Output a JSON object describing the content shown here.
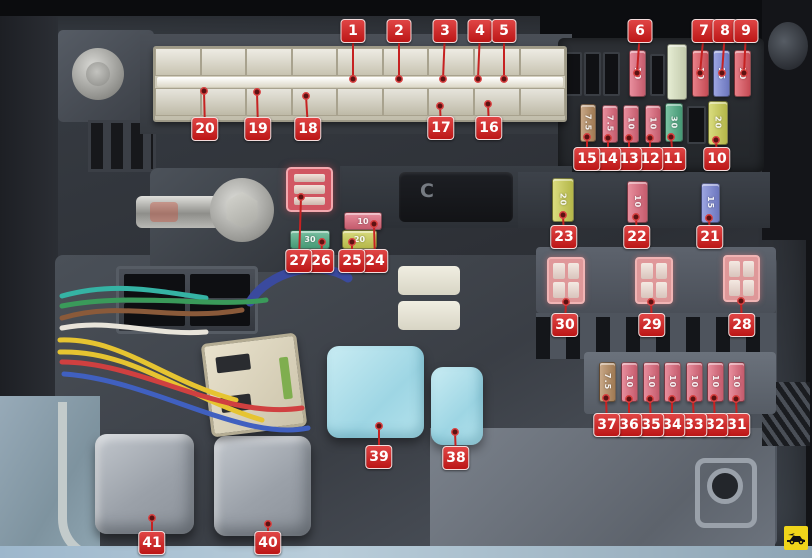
{
  "figure": {
    "type": "annotated-photo-diagram",
    "subject": "engine compartment fuse and relay box",
    "relay_cover_letter": "C",
    "watermark_icon": "car-logo",
    "accent_color": "#c81e1e",
    "callout_bg": "#c81e1e"
  },
  "amp_values_visible": [
    "7.5",
    "10",
    "15",
    "20",
    "30"
  ],
  "fuse_colors": {
    "pink": "#e0687c",
    "red": "#e05560",
    "blue": "#7b87d8",
    "tan": "#b58a5e",
    "green": "#4fae85",
    "yellow": "#cdd053",
    "pale": "#dde6c4"
  },
  "wire_colors": [
    "#35b3a4",
    "#3a9a5a",
    "#8a5a3a",
    "#e8e4da",
    "#e6c431",
    "#e6c431",
    "#d04040",
    "#4060c0"
  ],
  "thick_wire_color": "#3a4a9e",
  "callouts": [
    {
      "n": "1",
      "lx": 353,
      "ly": 31,
      "dx": 353,
      "dy": 79
    },
    {
      "n": "2",
      "lx": 399,
      "ly": 31,
      "dx": 399,
      "dy": 79
    },
    {
      "n": "3",
      "lx": 445,
      "ly": 31,
      "dx": 443,
      "dy": 79
    },
    {
      "n": "4",
      "lx": 480,
      "ly": 31,
      "dx": 478,
      "dy": 79
    },
    {
      "n": "5",
      "lx": 504,
      "ly": 31,
      "dx": 504,
      "dy": 79
    },
    {
      "n": "6",
      "lx": 640,
      "ly": 31,
      "dx": 637,
      "dy": 73
    },
    {
      "n": "7",
      "lx": 704,
      "ly": 31,
      "dx": 700,
      "dy": 73
    },
    {
      "n": "8",
      "lx": 725,
      "ly": 31,
      "dx": 722,
      "dy": 73
    },
    {
      "n": "9",
      "lx": 746,
      "ly": 31,
      "dx": 744,
      "dy": 73
    },
    {
      "n": "10",
      "lx": 717,
      "ly": 159,
      "dx": 716,
      "dy": 140
    },
    {
      "n": "11",
      "lx": 673,
      "ly": 159,
      "dx": 671,
      "dy": 137
    },
    {
      "n": "12",
      "lx": 650,
      "ly": 159,
      "dx": 650,
      "dy": 138
    },
    {
      "n": "13",
      "lx": 629,
      "ly": 159,
      "dx": 629,
      "dy": 138
    },
    {
      "n": "14",
      "lx": 608,
      "ly": 159,
      "dx": 608,
      "dy": 138
    },
    {
      "n": "15",
      "lx": 587,
      "ly": 159,
      "dx": 587,
      "dy": 137
    },
    {
      "n": "16",
      "lx": 489,
      "ly": 128,
      "dx": 488,
      "dy": 104
    },
    {
      "n": "17",
      "lx": 441,
      "ly": 128,
      "dx": 440,
      "dy": 106
    },
    {
      "n": "18",
      "lx": 308,
      "ly": 129,
      "dx": 306,
      "dy": 96
    },
    {
      "n": "19",
      "lx": 258,
      "ly": 129,
      "dx": 257,
      "dy": 92
    },
    {
      "n": "20",
      "lx": 205,
      "ly": 129,
      "dx": 204,
      "dy": 91
    },
    {
      "n": "21",
      "lx": 710,
      "ly": 237,
      "dx": 709,
      "dy": 218
    },
    {
      "n": "22",
      "lx": 637,
      "ly": 237,
      "dx": 636,
      "dy": 217
    },
    {
      "n": "23",
      "lx": 564,
      "ly": 237,
      "dx": 563,
      "dy": 215
    },
    {
      "n": "24",
      "lx": 375,
      "ly": 261,
      "dx": 374,
      "dy": 224
    },
    {
      "n": "25",
      "lx": 352,
      "ly": 261,
      "dx": 352,
      "dy": 242
    },
    {
      "n": "26",
      "lx": 321,
      "ly": 261,
      "dx": 322,
      "dy": 242
    },
    {
      "n": "27",
      "lx": 299,
      "ly": 261,
      "dx": 301,
      "dy": 197
    },
    {
      "n": "28",
      "lx": 742,
      "ly": 325,
      "dx": 741,
      "dy": 301
    },
    {
      "n": "29",
      "lx": 652,
      "ly": 325,
      "dx": 651,
      "dy": 302
    },
    {
      "n": "30",
      "lx": 565,
      "ly": 325,
      "dx": 566,
      "dy": 302
    },
    {
      "n": "31",
      "lx": 737,
      "ly": 425,
      "dx": 736,
      "dy": 399
    },
    {
      "n": "32",
      "lx": 715,
      "ly": 425,
      "dx": 714,
      "dy": 398
    },
    {
      "n": "33",
      "lx": 694,
      "ly": 425,
      "dx": 693,
      "dy": 399
    },
    {
      "n": "34",
      "lx": 672,
      "ly": 425,
      "dx": 672,
      "dy": 399
    },
    {
      "n": "35",
      "lx": 651,
      "ly": 425,
      "dx": 650,
      "dy": 399
    },
    {
      "n": "36",
      "lx": 629,
      "ly": 425,
      "dx": 629,
      "dy": 399
    },
    {
      "n": "37",
      "lx": 607,
      "ly": 425,
      "dx": 606,
      "dy": 398
    },
    {
      "n": "38",
      "lx": 456,
      "ly": 458,
      "dx": 455,
      "dy": 432
    },
    {
      "n": "39",
      "lx": 379,
      "ly": 457,
      "dx": 379,
      "dy": 426
    },
    {
      "n": "40",
      "lx": 268,
      "ly": 543,
      "dx": 268,
      "dy": 524
    },
    {
      "n": "41",
      "lx": 152,
      "ly": 543,
      "dx": 152,
      "dy": 518
    }
  ],
  "fuses": [
    {
      "amp": "10",
      "color": "pink",
      "x": 629,
      "y": 50,
      "w": 15,
      "h": 45,
      "vert": true
    },
    {
      "amp": "",
      "color": "pale",
      "x": 667,
      "y": 44,
      "w": 18,
      "h": 54,
      "vert": true
    },
    {
      "amp": "10",
      "color": "red",
      "x": 692,
      "y": 50,
      "w": 15,
      "h": 45,
      "vert": true
    },
    {
      "amp": "15",
      "color": "blue",
      "x": 713,
      "y": 50,
      "w": 15,
      "h": 45,
      "vert": true
    },
    {
      "amp": "10",
      "color": "red",
      "x": 734,
      "y": 50,
      "w": 15,
      "h": 45,
      "vert": true
    },
    {
      "amp": "7.5",
      "color": "tan",
      "x": 580,
      "y": 104,
      "w": 14,
      "h": 36,
      "vert": true
    },
    {
      "amp": "7.5",
      "color": "pink",
      "x": 602,
      "y": 105,
      "w": 14,
      "h": 36,
      "vert": true
    },
    {
      "amp": "10",
      "color": "pink",
      "x": 623,
      "y": 105,
      "w": 14,
      "h": 36,
      "vert": true
    },
    {
      "amp": "10",
      "color": "pink",
      "x": 645,
      "y": 105,
      "w": 14,
      "h": 36,
      "vert": true
    },
    {
      "amp": "30",
      "color": "green",
      "x": 665,
      "y": 103,
      "w": 16,
      "h": 37,
      "vert": true
    },
    {
      "amp": "20",
      "color": "yellow",
      "x": 708,
      "y": 101,
      "w": 18,
      "h": 42,
      "vert": true
    },
    {
      "amp": "20",
      "color": "yellow",
      "x": 552,
      "y": 178,
      "w": 20,
      "h": 42,
      "vert": true
    },
    {
      "amp": "10",
      "color": "pink",
      "x": 627,
      "y": 181,
      "w": 19,
      "h": 40,
      "vert": true
    },
    {
      "amp": "15",
      "color": "blue",
      "x": 701,
      "y": 183,
      "w": 17,
      "h": 38,
      "vert": true
    },
    {
      "amp": "10",
      "color": "pink",
      "x": 344,
      "y": 212,
      "w": 36,
      "h": 16,
      "vert": false
    },
    {
      "amp": "30",
      "color": "green",
      "x": 290,
      "y": 230,
      "w": 38,
      "h": 17,
      "vert": false
    },
    {
      "amp": "20",
      "color": "yellow",
      "x": 342,
      "y": 230,
      "w": 33,
      "h": 17,
      "vert": false
    },
    {
      "amp": "7.5",
      "color": "tan",
      "x": 599,
      "y": 362,
      "w": 15,
      "h": 38,
      "vert": true
    },
    {
      "amp": "10",
      "color": "pink",
      "x": 621,
      "y": 362,
      "w": 15,
      "h": 38,
      "vert": true
    },
    {
      "amp": "10",
      "color": "pink",
      "x": 643,
      "y": 362,
      "w": 15,
      "h": 38,
      "vert": true
    },
    {
      "amp": "10",
      "color": "pink",
      "x": 664,
      "y": 362,
      "w": 15,
      "h": 38,
      "vert": true
    },
    {
      "amp": "10",
      "color": "pink",
      "x": 686,
      "y": 362,
      "w": 15,
      "h": 38,
      "vert": true
    },
    {
      "amp": "10",
      "color": "pink",
      "x": 707,
      "y": 362,
      "w": 15,
      "h": 38,
      "vert": true
    },
    {
      "amp": "10",
      "color": "pink",
      "x": 728,
      "y": 362,
      "w": 15,
      "h": 38,
      "vert": true
    }
  ],
  "empty_slots": [
    {
      "x": 565,
      "y": 52,
      "w": 13,
      "h": 40
    },
    {
      "x": 584,
      "y": 52,
      "w": 13,
      "h": 40
    },
    {
      "x": 603,
      "y": 52,
      "w": 13,
      "h": 40
    },
    {
      "x": 650,
      "y": 54,
      "w": 11,
      "h": 38
    },
    {
      "x": 687,
      "y": 106,
      "w": 15,
      "h": 34
    }
  ],
  "relays": {
    "pink": [
      {
        "x": 547,
        "y": 257,
        "w": 38,
        "h": 47
      },
      {
        "x": 635,
        "y": 257,
        "w": 38,
        "h": 47
      },
      {
        "x": 723,
        "y": 255,
        "w": 37,
        "h": 47
      }
    ],
    "red": [
      {
        "x": 286,
        "y": 167,
        "w": 47,
        "h": 45
      }
    ],
    "blue": [
      {
        "x": 327,
        "y": 346,
        "w": 97,
        "h": 92
      },
      {
        "x": 431,
        "y": 367,
        "w": 52,
        "h": 78
      }
    ],
    "gray": [
      {
        "x": 95,
        "y": 434,
        "w": 99,
        "h": 100
      },
      {
        "x": 214,
        "y": 436,
        "w": 97,
        "h": 100
      }
    ]
  },
  "fusible_link": {
    "columns": 9,
    "rows": 2
  }
}
